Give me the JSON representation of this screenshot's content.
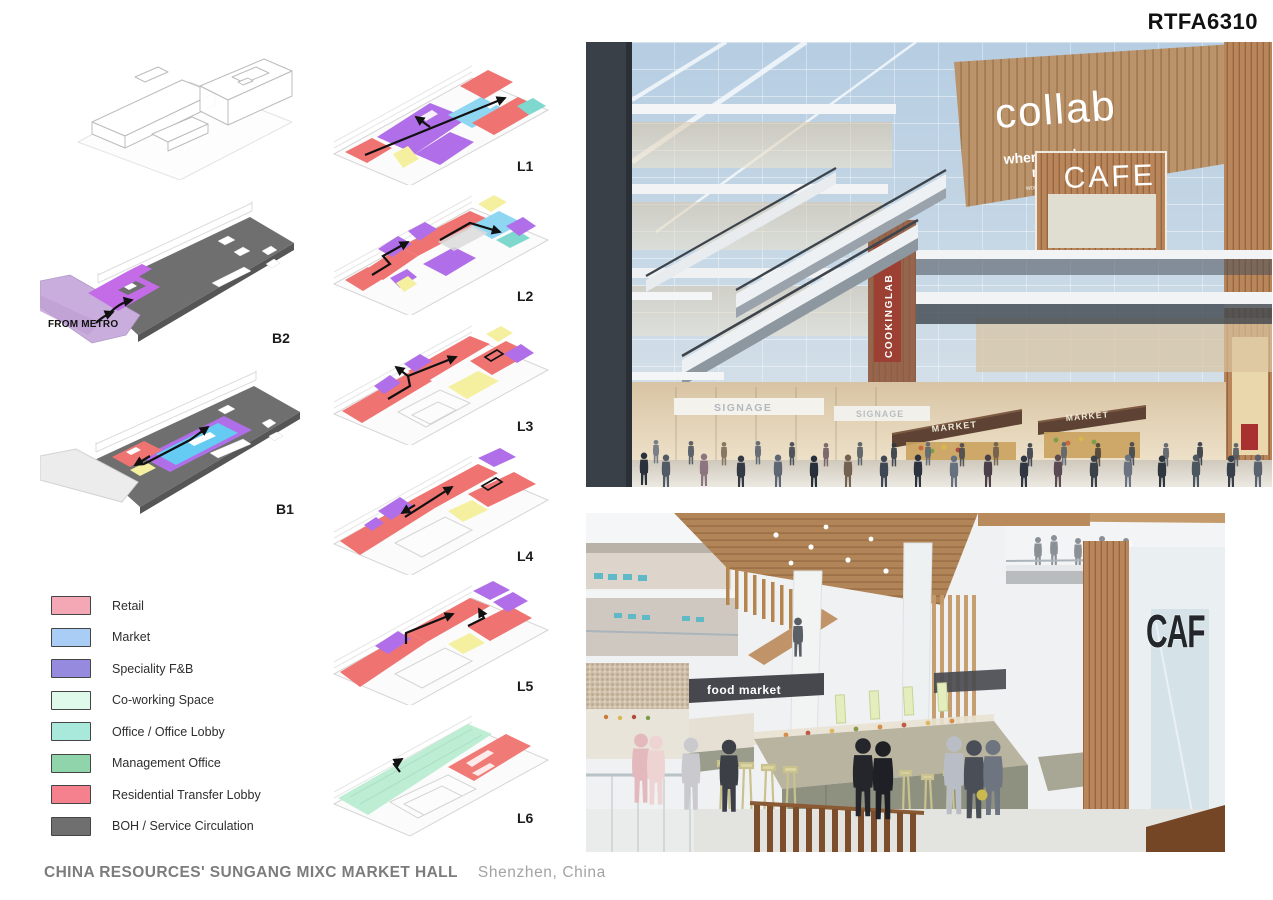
{
  "board": {
    "code": "RTFA6310"
  },
  "footer": {
    "title": "CHINA RESOURCES' SUNGANG MIXC MARKET HALL",
    "location": "Shenzhen, China"
  },
  "diagrams": {
    "b2": {
      "label": "B2",
      "annotation": "FROM METRO"
    },
    "b1": {
      "label": "B1"
    },
    "levels": [
      {
        "label": "L1"
      },
      {
        "label": "L2"
      },
      {
        "label": "L3"
      },
      {
        "label": "L4"
      },
      {
        "label": "L5"
      },
      {
        "label": "L6"
      }
    ]
  },
  "legend": {
    "items": [
      {
        "label": "Retail",
        "color": "#F4A7B4"
      },
      {
        "label": "Market",
        "color": "#A9CDF4"
      },
      {
        "label": "Speciality F&B",
        "color": "#968ADF"
      },
      {
        "label": "Co-working Space",
        "color": "#DFFAEA"
      },
      {
        "label": "Office / Office Lobby",
        "color": "#A8E9DC"
      },
      {
        "label": "Management Office",
        "color": "#8FD4AA"
      },
      {
        "label": "Residential Transfer Lobby",
        "color": "#F5808E"
      },
      {
        "label": "BOH / Service Circulation",
        "color": "#6F6F6F"
      }
    ]
  },
  "renders": {
    "atrium": {
      "signs": {
        "collab": "collab",
        "tagline_line1": "where work",
        "tagline_line2": "meets life",
        "tagline_sub": "work · cafe · gym",
        "cafe": "CAFE",
        "cookinglab": "COOKINGLAB",
        "signage_left": "SIGNAGE",
        "signage_right": "SIGNAGE",
        "market_left": "MARKET",
        "market_right": "MARKET"
      }
    },
    "market_hall": {
      "signs": {
        "food_market": "food market",
        "cafe_partial": "CAF"
      }
    }
  }
}
